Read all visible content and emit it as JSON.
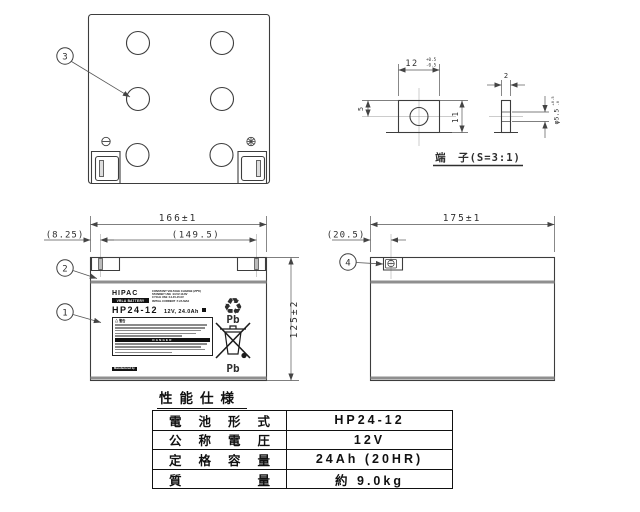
{
  "page": {
    "background": "#ffffff",
    "line_color": "#3d3d3d",
    "seam_color": "#8f8f8f"
  },
  "icons": {
    "recycle": "♻"
  },
  "callouts": {
    "c1": "1",
    "c2": "2",
    "c3": "3",
    "c4": "4"
  },
  "dims": {
    "front_width": "166±1",
    "front_pitch": "(149.5)",
    "front_offset": "(8.25)",
    "front_height": "125±2",
    "side_width": "175±1",
    "side_offset": "(20.5)",
    "term_width": "12",
    "term_width_tol_up": "+0.5",
    "term_width_tol_dn": "-0.5",
    "term_top": "5",
    "term_height": "11",
    "term_thickness": "2",
    "term_hole": "φ5.5",
    "term_hole_tol_up": "+0.5",
    "term_hole_tol_dn": "-0",
    "term_title": "端　子(S=3:1)"
  },
  "label": {
    "brand": "HIPAC",
    "brand_sub": "VRLA BATTERY",
    "charge_title": "CONSTANT VOLTAGE CHARGE (25℃)",
    "charge_lines": [
      "STANDBY USE :13.5V-13.8V",
      "CYCLE USE :14.4V-15.0V",
      "INITIAL CURRENT :7.2A MAX"
    ],
    "model": "HP24-12",
    "rating": "12V, 24.0Ah",
    "warning_heading": "△ 警告",
    "danger_heading": "DANGER",
    "mfr_heading": "Manufactured by",
    "mfr_company": "Shin-Kobe Electric Machinery Co.,Ltd",
    "made_in": "MADE IN JAPAN",
    "pb": "Pb"
  },
  "spec": {
    "title": "性能仕様",
    "rows": [
      {
        "k": "電池形式",
        "v": "HP24-12"
      },
      {
        "k": "公称電圧",
        "v": "12V"
      },
      {
        "k": "定格容量",
        "v": "24Ah (20HR)"
      },
      {
        "k": "質量",
        "v": "約 9.0kg"
      }
    ]
  }
}
